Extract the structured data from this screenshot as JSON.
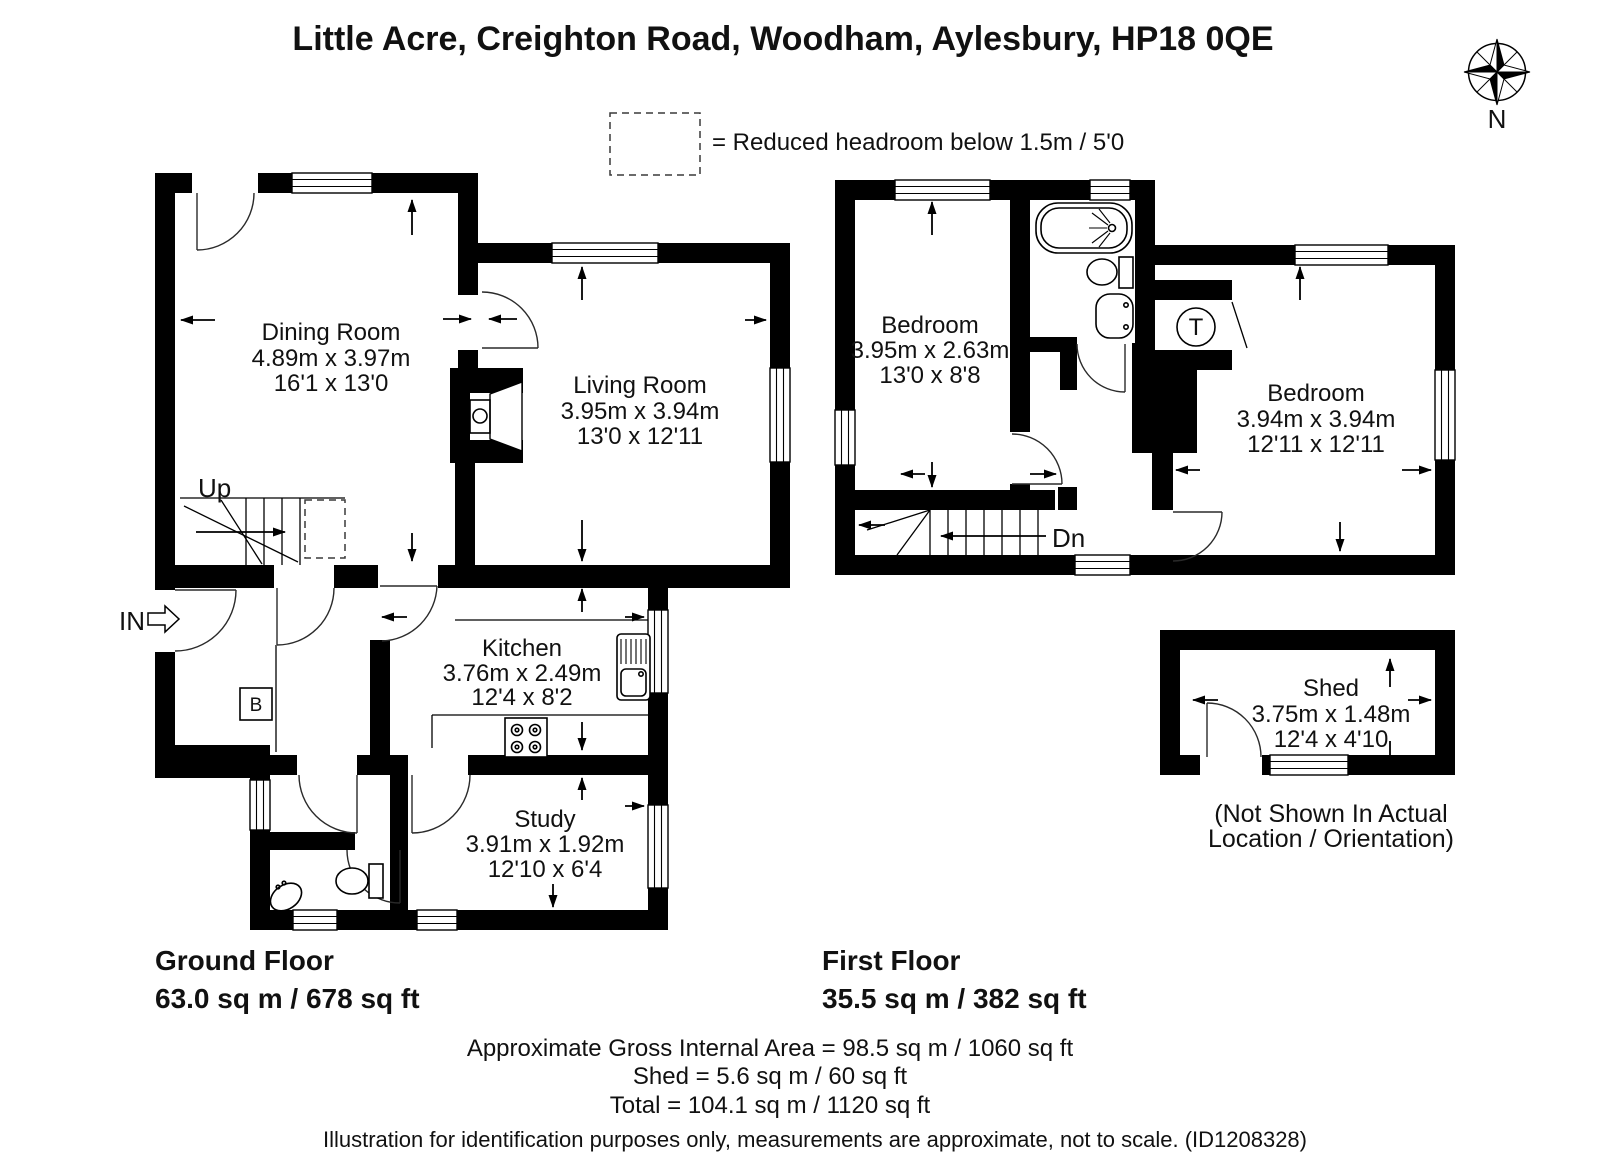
{
  "title": "Little Acre, Creighton Road, Woodham, Aylesbury, HP18 0QE",
  "compass": {
    "north_label": "N"
  },
  "legend": {
    "reduced_headroom": "= Reduced headroom below 1.5m / 5'0"
  },
  "ground_floor": {
    "title": "Ground Floor",
    "area": "63.0 sq m / 678 sq ft",
    "stairs_label": "Up",
    "entrance_label": "IN",
    "boiler_label": "B",
    "rooms": {
      "dining": {
        "name": "Dining Room",
        "metric": "4.89m x 3.97m",
        "imperial": "16'1 x 13'0"
      },
      "living": {
        "name": "Living Room",
        "metric": "3.95m x 3.94m",
        "imperial": "13'0 x 12'11"
      },
      "kitchen": {
        "name": "Kitchen",
        "metric": "3.76m x 2.49m",
        "imperial": "12'4 x 8'2"
      },
      "study": {
        "name": "Study",
        "metric": "3.91m x 1.92m",
        "imperial": "12'10 x 6'4"
      }
    }
  },
  "first_floor": {
    "title": "First Floor",
    "area": "35.5 sq m / 382 sq ft",
    "stairs_label": "Dn",
    "tank_label": "T",
    "rooms": {
      "bedroom1": {
        "name": "Bedroom",
        "metric": "3.95m x 2.63m",
        "imperial": "13'0 x 8'8"
      },
      "bedroom2": {
        "name": "Bedroom",
        "metric": "3.94m x 3.94m",
        "imperial": "12'11 x 12'11"
      }
    }
  },
  "shed": {
    "name": "Shed",
    "metric": "3.75m x 1.48m",
    "imperial": "12'4 x 4'10",
    "note_line1": "(Not Shown In Actual",
    "note_line2": "Location / Orientation)"
  },
  "summary": {
    "gross_internal_area": "Approximate Gross Internal Area = 98.5 sq m / 1060 sq ft",
    "shed_area": "Shed = 5.6 sq m / 60 sq ft",
    "total_area": "Total = 104.1 sq m / 1120 sq ft"
  },
  "disclaimer": "Illustration for identification purposes only, measurements are approximate, not to scale. (ID1208328)"
}
